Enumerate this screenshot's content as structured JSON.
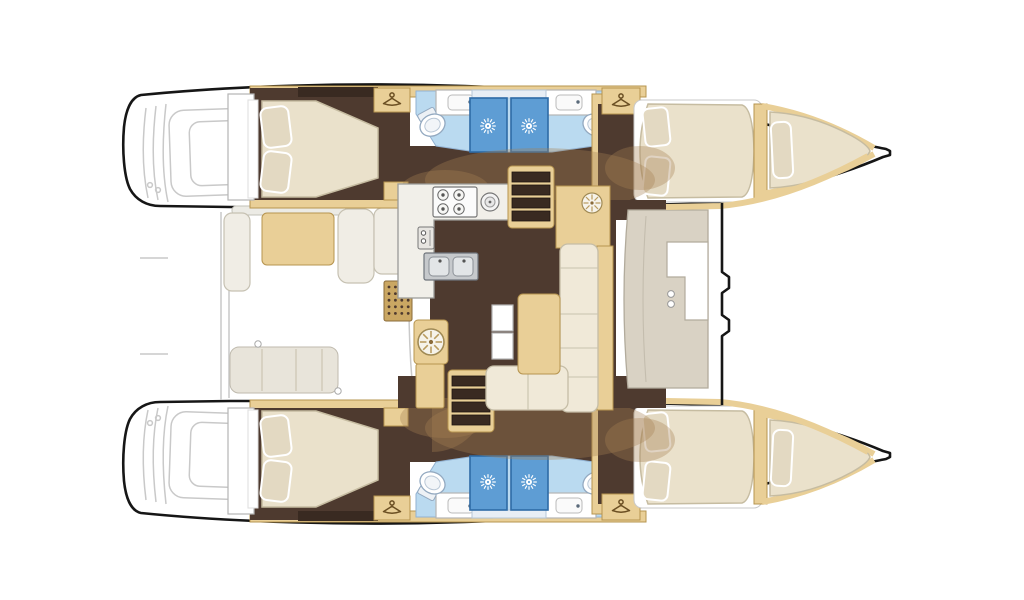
{
  "meta": {
    "title": "Catamaran 4-cabin interior layout — top-down floor plan",
    "style": "architectural brochure floor plan, no text labels",
    "background": "#ffffff",
    "orientation": "bows pointing right, sterns to the left"
  },
  "palette": {
    "outline": "#161616",
    "faint_line": "#c9c9c9",
    "wood_tan": "#e9cf97",
    "wood_tan_stroke": "#b6944f",
    "wood_tan_deep": "#caa763",
    "floor_brown": "#4e3a2f",
    "floor_dark": "#392a21",
    "shade_overlay": "rgba(167,128,82,0.35)",
    "bed_cream": "#eae1cb",
    "bed_stroke": "#c6bca1",
    "pillow_cream": "#e3d9c2",
    "bath_blue": "#badaf0",
    "bath_stroke": "#92b2d2",
    "shower_blue": "#5e9dd4",
    "shower_stroke": "#2e6ba6",
    "cushion_grey": "#d9d2c4",
    "cushion_stroke": "#b2ab9c",
    "sofa_cream": "#f0e9d8",
    "sofa_stroke": "#c5bda6",
    "sink_grey": "#c6c9cc",
    "offwhite": "#f1efe9"
  },
  "vessel": {
    "type": "sailing catamaran",
    "view": "top-down interior layout plan",
    "hull_count": 2,
    "layout_version": "4 cabins / 4 heads",
    "hulls": [
      {
        "id": "port",
        "position": "top",
        "rooms": [
          {
            "name": "aft cabin",
            "bed": "double bed, two pillows at left, tapered foot to right",
            "wardrobe_hanger_icon": true,
            "floor": "dark brown"
          },
          {
            "name": "aft head",
            "fixtures": [
              "toilet",
              "washbasin counter",
              "shower cubicle with sun symbol"
            ],
            "floor": "light blue"
          },
          {
            "name": "forward head",
            "fixtures": [
              "toilet",
              "washbasin counter",
              "shower cubicle with sun symbol"
            ],
            "floor": "light blue"
          },
          {
            "name": "forward cabin",
            "bed": "double bed, two pillows at left",
            "wardrobe_hanger_icon": true,
            "floor": "dark brown"
          },
          {
            "name": "forepeak berth",
            "bed": "wedge single berth with pillow"
          }
        ]
      },
      {
        "id": "starboard",
        "position": "bottom",
        "rooms": [
          {
            "name": "aft cabin",
            "bed": "double bed, two pillows at left, tapered foot to right",
            "wardrobe_hanger_icon": true,
            "floor": "dark brown"
          },
          {
            "name": "aft head",
            "fixtures": [
              "toilet",
              "washbasin counter",
              "shower cubicle with sun symbol"
            ],
            "floor": "light blue"
          },
          {
            "name": "forward head",
            "fixtures": [
              "toilet",
              "washbasin counter",
              "shower cubicle with sun symbol"
            ],
            "floor": "light blue"
          },
          {
            "name": "forward cabin",
            "bed": "double bed, two pillows at left",
            "wardrobe_hanger_icon": true,
            "floor": "dark brown"
          },
          {
            "name": "forepeak berth",
            "bed": "wedge single berth with pillow"
          }
        ]
      }
    ],
    "bridgedeck": {
      "galley": {
        "hob_burners": 4,
        "round_sink": 1,
        "double_sink_bowls": 2,
        "appliance_front_with_two_dials": 1,
        "counter_shape": "L-shaped, white"
      },
      "salon": {
        "sofa": "L-shaped settee, cream cushions with seams",
        "coffee_table": "rectangular wooden table",
        "side_tables": 2,
        "round_radial_top_tables": 2
      },
      "companionway_stairs": [
        {
          "to": "port hull",
          "treads": 4
        },
        {
          "to": "starboard hull",
          "treads": 4
        }
      ]
    },
    "aft_cockpit": {
      "position": "left between sterns",
      "features": [
        "bench with table",
        "side cushion seats",
        "slatted grate",
        "aft bench with seams",
        "door swing arc"
      ]
    },
    "forward_cockpit": {
      "position": "right of salon front bulkhead",
      "features": [
        "C-shaped lounge seat",
        "two cup holders"
      ]
    },
    "exterior": {
      "transom_steps": "faint grey outlines at both sterns",
      "trampoline_area": "open white area between bows",
      "bow_side_decks": "tan strips converging to bow tips"
    }
  },
  "icons": [
    {
      "name": "hanger-icon",
      "meaning": "wardrobe / hanging locker",
      "count": 4
    },
    {
      "name": "shower-sun-icon",
      "meaning": "shower rose",
      "count": 4
    },
    {
      "name": "burner-icon",
      "meaning": "galley hob burner",
      "count": 4
    },
    {
      "name": "toilet-icon",
      "count": 4
    },
    {
      "name": "washbasin-icon",
      "count": 4
    },
    {
      "name": "radial-table-icon",
      "count": 2
    },
    {
      "name": "stairs-icon",
      "count": 2
    }
  ]
}
